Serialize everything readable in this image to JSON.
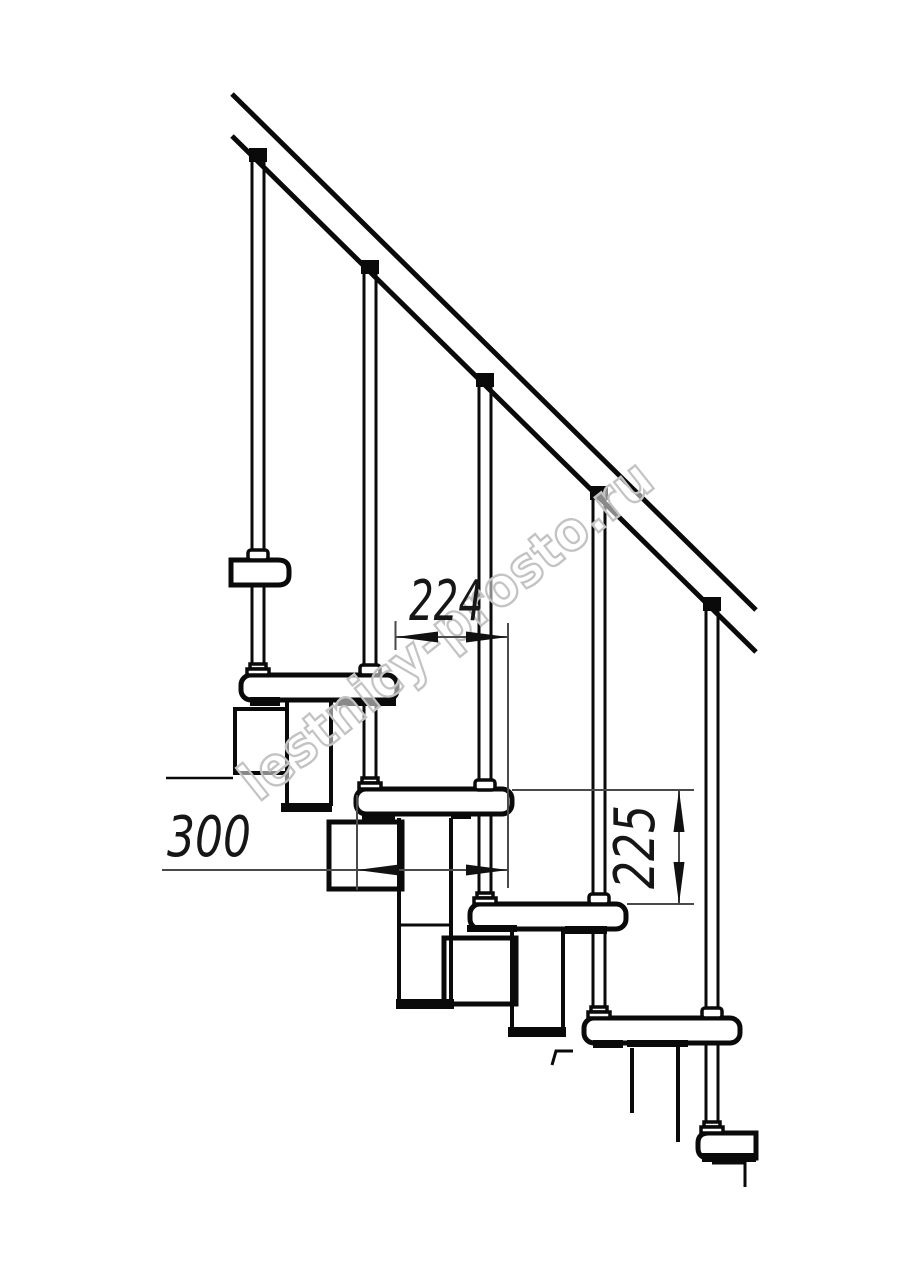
{
  "drawing": {
    "title": "modular-staircase-side-elevation-fragment",
    "units": "mm",
    "dimensions": {
      "step_run": {
        "value": "224",
        "orientation": "horizontal",
        "meaning": "going between tread noses"
      },
      "tread_depth": {
        "value": "300",
        "orientation": "horizontal",
        "meaning": "tread depth"
      },
      "step_rise": {
        "value": "225",
        "orientation": "vertical",
        "meaning": "riser height between treads"
      }
    },
    "watermark": {
      "text": "lestnicy-prosto.ru"
    },
    "colors": {
      "line": "#0a0a0a",
      "dimension_line": "#4a4a4a",
      "dimension_text": "#161616",
      "watermark_stroke": "#c3c3c3",
      "background": "#ffffff"
    },
    "parts": {
      "handrail": "inclined handrail band",
      "balusters": 5,
      "treads": 6,
      "stringer": "zigzag modular stringer boxes"
    }
  }
}
